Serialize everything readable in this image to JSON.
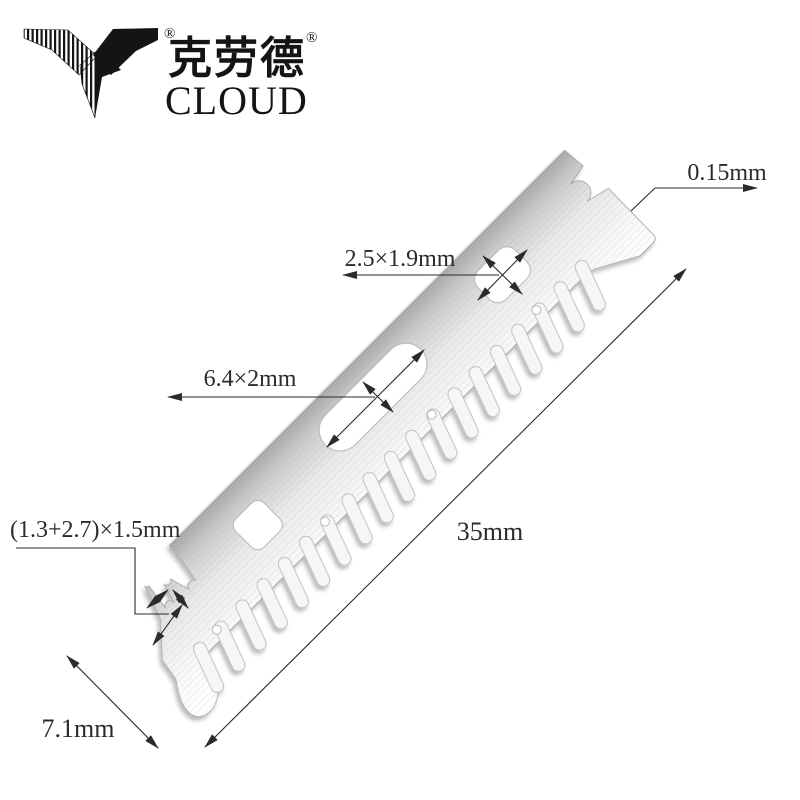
{
  "brand": {
    "name_cn": "克劳德",
    "name_en": "CLOUD",
    "registered_mark": "®"
  },
  "dimensions": {
    "thickness": "0.15mm",
    "coupling_hole": "2.5×1.9mm",
    "center_slot": "6.4×2mm",
    "end_notch": "(1.3+2.7)×1.5mm",
    "blade_length": "35mm",
    "blade_width": "7.1mm"
  },
  "colors": {
    "ink": "#2b2b2b",
    "logo": "#141414",
    "metal_dark": "#a9a9a9",
    "metal_light": "#ffffff",
    "background": "#ffffff"
  }
}
